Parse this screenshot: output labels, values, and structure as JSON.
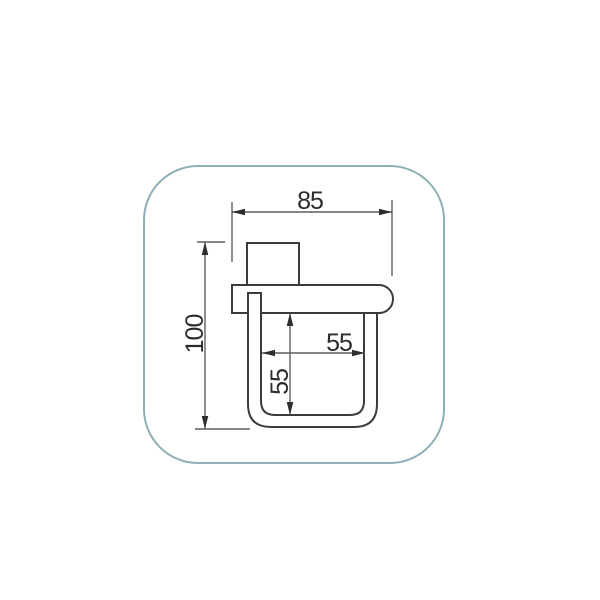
{
  "drawing": {
    "kind": "dimensioned technical drawing",
    "dimensions": {
      "overall_width_mm": "85",
      "overall_height_mm": "100",
      "inner_width_mm": "55",
      "inner_depth_mm": "55"
    },
    "colors": {
      "frame_border": "#8fafb7",
      "part_outline": "#3c3c3c",
      "dimension_line": "#5f5f5f",
      "arrow": "#2e2e2e",
      "text": "#2b2b2b",
      "background": "#ffffff"
    }
  }
}
